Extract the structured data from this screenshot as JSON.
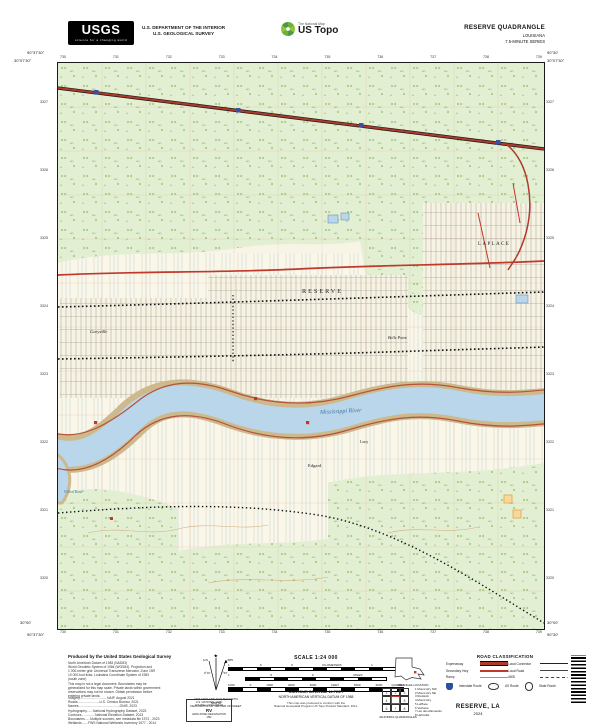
{
  "header": {
    "logo_text": "USGS",
    "logo_tagline": "science for a changing world",
    "dept1": "U.S. DEPARTMENT OF THE INTERIOR",
    "dept2": "U.S. GEOLOGICAL SURVEY",
    "ustopo_small": "The National Map",
    "ustopo_big": "US Topo",
    "quad": "RESERVE QUADRANGLE",
    "state": "LOUISIANA",
    "series": "7.5-MINUTE SERIES"
  },
  "collar": {
    "tl_lon": "90°37'30\"",
    "tl_lat": "30°07'30\"",
    "tr_lon": "90°30'",
    "tr_lat": "30°07'30\"",
    "bl_lat": "30°00'",
    "bl_lon": "90°37'30\"",
    "br_lat": "30°00'",
    "br_lon": "90°30'",
    "top_ticks": [
      "730",
      "731",
      "732",
      "733",
      "734",
      "735",
      "736",
      "737",
      "738",
      "739"
    ],
    "bottom_ticks": [
      "730",
      "731",
      "732",
      "733",
      "734",
      "735",
      "736",
      "737",
      "738",
      "739"
    ],
    "left_ticks": [
      "3327",
      "3326",
      "3325",
      "3324",
      "3323",
      "3322",
      "3321",
      "3320"
    ],
    "right_ticks": [
      "3327",
      "3326",
      "3325",
      "3324",
      "3323",
      "3322",
      "3321",
      "3320"
    ]
  },
  "map": {
    "labels": {
      "reserve": "RESERVE",
      "garyville": "Garyville",
      "laplace": "LAPLACE",
      "belle_point": "Belle Point",
      "river": "Mississippi River",
      "edgard": "Edgard",
      "lucy": "Lucy",
      "willow_bend": "Willow Bend"
    },
    "colors": {
      "water": "#b9d6ea",
      "vegetation": "#e3efd3",
      "primary_road": "#c0392b",
      "interstate_marker": "#3b4fa0"
    }
  },
  "footer": {
    "produced_by": "Produced by the United States Geological Survey",
    "fine_print": [
      "North American Datum of 1983 (NAD83)",
      "World Geodetic System of 1984 (WGS84). Projection and",
      "1 000-meter grid: Universal Transverse Mercator, Zone 15R",
      "10 000-foot ticks: Louisiana Coordinate System of 1983",
      "(south zone)",
      "This map is not a legal document. Boundaries may be",
      "generalized for this map scale. Private lands within government",
      "reservations may not be shown. Obtain permission before",
      "entering private lands."
    ],
    "credits": [
      "Imagery..............................NAIP, August 2021",
      "Roads........................U.S. Census Bureau, 2021",
      "Names.............................................GNIS, 2023",
      "Hydrography.......National Hydrography Dataset, 2023",
      "Contours...............National Elevation Dataset, 2013",
      "Boundaries......Multiple sources; see metadata file 1972 - 2023",
      "Wetlands.......FWS National Wetlands Inventory 1977 - 2014"
    ],
    "declination": {
      "star": "★",
      "gn": "GN",
      "mn": "MN",
      "gn_angle": "0°16'",
      "mn_angle": "1°03'",
      "cap1": "UTM GRID AND 2024 MAGNETIC NORTH",
      "cap2": "DECLINATION AT CENTER OF SHEET"
    },
    "usng": {
      "l1": "U.S. NATIONAL GRID",
      "l2": "100,000-m SQUARE ID",
      "id": "RV",
      "l3": "GRID ZONE DESIGNATION",
      "zone": "15R"
    },
    "scale": {
      "title": "SCALE 1:24 000",
      "km_nums": [
        "1",
        ".5",
        "0",
        "KILOMETERS",
        "1",
        "2"
      ],
      "mi_nums": [
        "1",
        ".5",
        "0",
        "MILES",
        "1"
      ],
      "ft_nums": [
        "1000",
        "0",
        "1000",
        "2000",
        "3000",
        "FEET",
        "5000",
        "6000",
        "7000"
      ]
    },
    "contour": "CONTOUR INTERVAL 10 FEET",
    "datum": "NORTH AMERICAN VERTICAL DATUM OF 1988",
    "standard1": "This map was produced to conform with the",
    "standard2": "National Geospatial Program US Topo Product Standard, 2011.",
    "location_caption": "QUADRANGLE LOCATION",
    "adjoining": {
      "caption": "ADJOINING QUADRANGLES",
      "cells": [
        "1",
        "2",
        "3",
        "4",
        "5",
        "6",
        "7",
        "8"
      ],
      "list": [
        "1 Mount Airy NW",
        "2 Mount Airy NE",
        "3 Ruddock",
        "4 Mount Airy",
        "5 LaPlace",
        "6 Vacherie",
        "7 Lac des Allemands",
        "8 Hahnville"
      ]
    },
    "road_class": {
      "title": "ROAD CLASSIFICATION",
      "expressway": "Expressway",
      "secondary": "Secondary Hwy",
      "ramp": "Ramp",
      "connector": "Local Connector",
      "local": "Local Road",
      "fwd": "4WD",
      "interstate": "Interstate Route",
      "us_route": "US Route",
      "state_route": "State Route"
    },
    "map_name": "RESERVE, LA",
    "year": "2024"
  }
}
